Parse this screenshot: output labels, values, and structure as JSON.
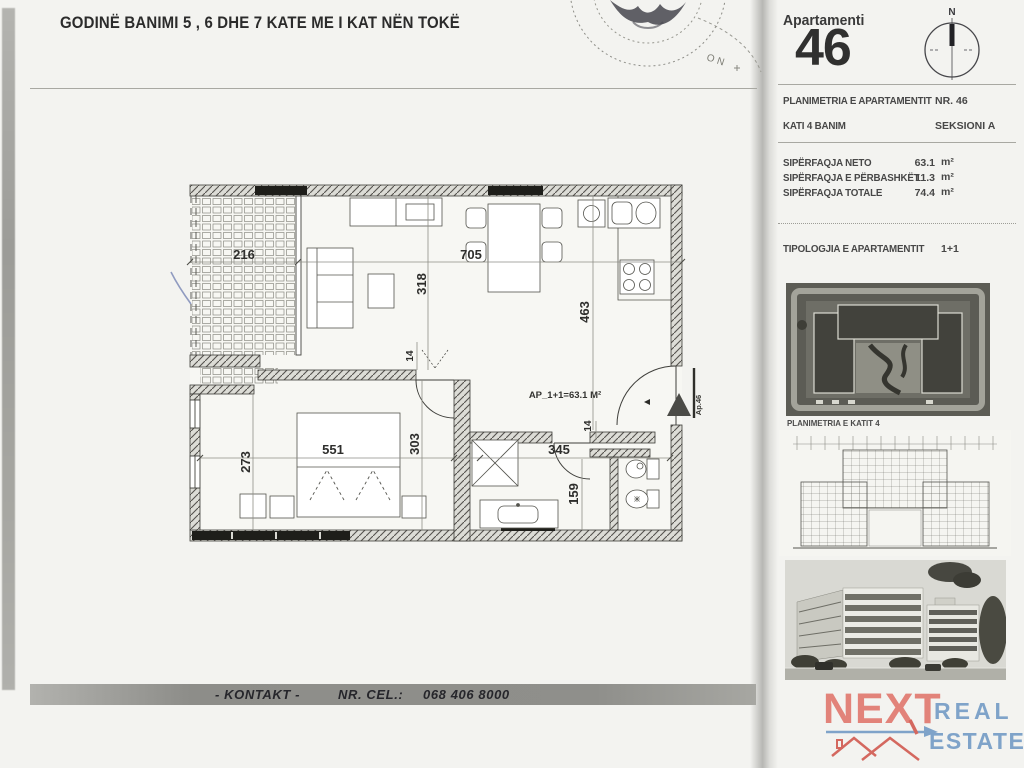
{
  "page": {
    "title": "GODINË BANIMI  5 , 6 DHE 7 KATE ME I KAT NËN TOKË"
  },
  "stamp": {
    "visible_text": "ON"
  },
  "plan": {
    "area_label": "AP_1+1=63.1 M²",
    "unit_marker": "Ap.46",
    "dims": {
      "balcony_width": "216",
      "living_width": "705",
      "living_depth": "318",
      "kitchen_depth": "463",
      "bedroom_width": "551",
      "bedroom_depth_left": "273",
      "bedroom_depth_right": "303",
      "bath_width": "345",
      "bath_depth": "159",
      "door_width_a": "14",
      "door_width_b": "14"
    }
  },
  "contact": {
    "kontakt": "- KONTAKT -",
    "cel_label": "NR. CEL.:",
    "phone": "068 406 8000"
  },
  "sidebar": {
    "apartment_word": "Apartamenti",
    "apartment_number": "46",
    "compass_north": "N",
    "plan_row_label": "PLANIMETRIA E APARTAMENTIT",
    "plan_row_value": "NR. 46",
    "floor_row_label": "KATI 4 BANIM",
    "floor_row_value": "SEKSIONI A",
    "areas": [
      {
        "label": "SIPËRFAQJA NETO",
        "value": "63.1",
        "unit": "m²"
      },
      {
        "label": "SIPËRFAQJA E PËRBASHKËT",
        "value": "11.3",
        "unit": "m²"
      },
      {
        "label": "SIPËRFAQJA TOTALE",
        "value": "74.4",
        "unit": "m²"
      }
    ],
    "typology_label": "TIPOLOGJIA E APARTAMENTIT",
    "typology_value": "1+1",
    "floorplan_caption": "PLANIMETRIA E KATIT 4"
  },
  "logo": {
    "next": "NEXT",
    "real": "REAL",
    "estate": "ESTATE"
  }
}
